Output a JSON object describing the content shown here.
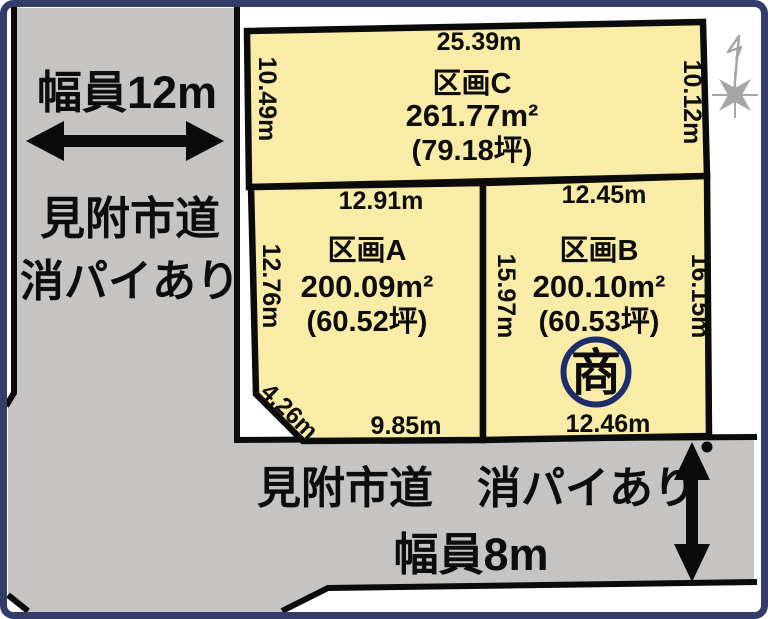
{
  "roads": {
    "left": {
      "width_label": "幅員12m",
      "name": "見附市道",
      "note": "消パイあり"
    },
    "bottom": {
      "label": "見附市道　消パイあり",
      "width_label": "幅員8m"
    }
  },
  "parcels": [
    {
      "id": "C",
      "name": "区画C",
      "area": "261.77m²",
      "tsubo": "(79.18坪)",
      "dim_top": "25.39m",
      "dim_left": "10.49m",
      "dim_right": "10.12m"
    },
    {
      "id": "A",
      "name": "区画A",
      "area": "200.09m²",
      "tsubo": "(60.52坪)",
      "dim_top": "12.91m",
      "dim_left": "12.76m",
      "dim_right": "15.97m",
      "dim_bottom": "9.85m",
      "dim_corner": "4.26m"
    },
    {
      "id": "B",
      "name": "区画B",
      "area": "200.10m²",
      "tsubo": "(60.53坪)",
      "dim_top": "12.45m",
      "dim_right": "16.15m",
      "dim_bottom": "12.46m",
      "seal": "商"
    }
  ],
  "icons": {
    "compass_north": "north-direction-star",
    "seal_mark": "商"
  },
  "colors": {
    "frame": "#343c6a",
    "road": "#c5c4c2",
    "parcel_fill": "#f8eca6",
    "line": "#0b0b0b",
    "seal": "#1d2d6e",
    "compass": "#a6a6a6"
  }
}
